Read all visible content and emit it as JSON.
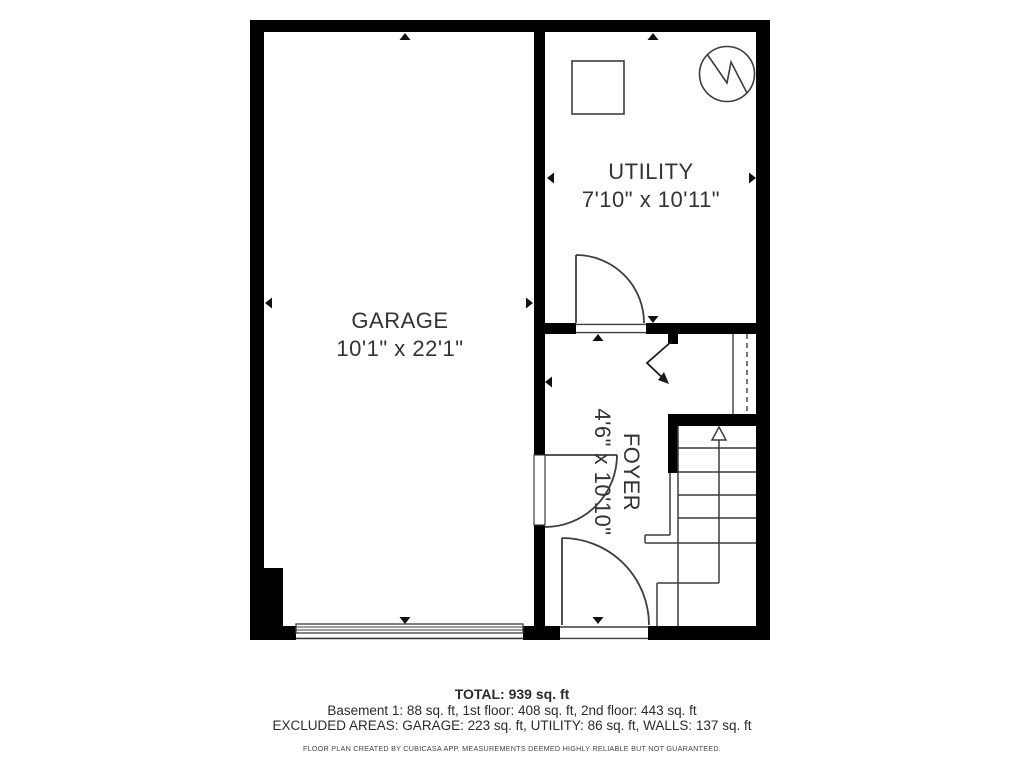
{
  "rooms": {
    "garage": {
      "name": "GARAGE",
      "dims": "10'1\" x 22'1\""
    },
    "utility": {
      "name": "UTILITY",
      "dims": "7'10\" x 10'11\""
    },
    "foyer": {
      "name": "FOYER",
      "dims": "4'6\" x 10'10\""
    }
  },
  "summary": {
    "total": "TOTAL: 939 sq. ft",
    "floors": "Basement 1: 88 sq. ft, 1st floor: 408 sq. ft, 2nd floor: 443 sq. ft",
    "excluded": "EXCLUDED AREAS: GARAGE: 223 sq. ft, UTILITY: 86 sq. ft, WALLS: 137 sq. ft",
    "disclaimer": "FLOOR PLAN CREATED BY CUBICASA APP. MEASUREMENTS DEEMED HIGHLY RELIABLE BUT NOT GUARANTEED."
  },
  "icons": {
    "water_heater": "water-heater-icon",
    "appliance": "appliance-icon",
    "stairs_arrow": "stairs-direction-arrow-icon",
    "dimension_marker": "dimension-arrow-marker"
  },
  "colors": {
    "wall": "#000000",
    "line": "#3d3d3d",
    "text": "#333333",
    "background": "#ffffff"
  }
}
